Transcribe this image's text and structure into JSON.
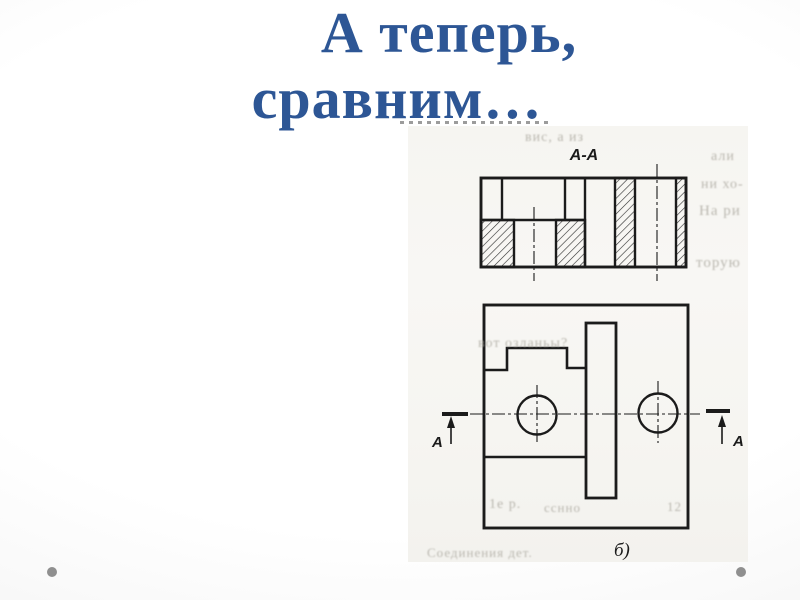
{
  "slide": {
    "title": {
      "line1": "А теперь,",
      "line2": "сравним…"
    }
  },
  "figure": {
    "section_label": "А-А",
    "view_label": "б)",
    "cut_left_letter": "А",
    "cut_right_letter": "А"
  },
  "scan": {
    "artifacts": [
      {
        "text": "вис, а из",
        "x": 525,
        "y": 130,
        "s": 14
      },
      {
        "text": "али",
        "x": 711,
        "y": 149,
        "s": 14
      },
      {
        "text": "ни хо-",
        "x": 701,
        "y": 177,
        "s": 14
      },
      {
        "text": "На ри",
        "x": 699,
        "y": 203,
        "s": 15
      },
      {
        "text": "торую",
        "x": 696,
        "y": 255,
        "s": 15
      },
      {
        "text": "вот озланьы?",
        "x": 478,
        "y": 336,
        "s": 14
      },
      {
        "text": "1е р.",
        "x": 489,
        "y": 497,
        "s": 14
      },
      {
        "text": "сснно",
        "x": 544,
        "y": 500,
        "s": 13
      },
      {
        "text": "12",
        "x": 667,
        "y": 499,
        "s": 13
      },
      {
        "text": "Соединения дет.",
        "x": 427,
        "y": 545,
        "s": 13
      }
    ]
  },
  "colors": {
    "title_blue": "#2d5695",
    "drawing_ink": "#1b1b1b",
    "scan_paper": "#f7f6f2",
    "slide_dot": "#8f8f8f"
  }
}
